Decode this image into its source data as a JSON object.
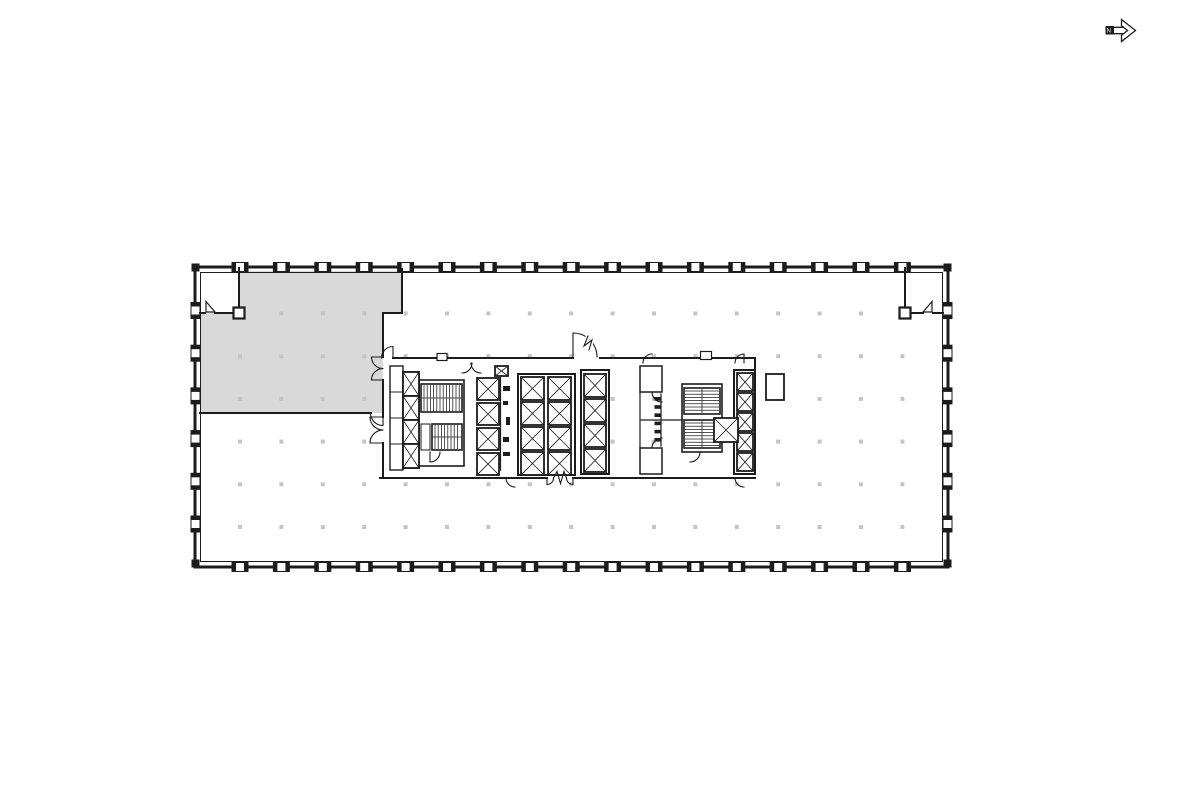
{
  "page": {
    "kind": "floor-plan-viewer"
  },
  "colors": {
    "line": "#1c1c1c",
    "shade": "#d9d9d9",
    "dot": "#c5c5c5",
    "background": "#ffffff"
  },
  "north_arrow": {
    "label": "N",
    "direction": "right"
  },
  "plan": {
    "kind": "office floor plate",
    "highlighted_area": {
      "location": "upper-left",
      "fill": "#d9d9d9"
    },
    "grid": {
      "columns": 17,
      "rows": 6
    },
    "core": {
      "elevator_shafts": 21,
      "stairwells": 4
    },
    "corner_rooms": [
      "top-left",
      "top-right"
    ]
  }
}
